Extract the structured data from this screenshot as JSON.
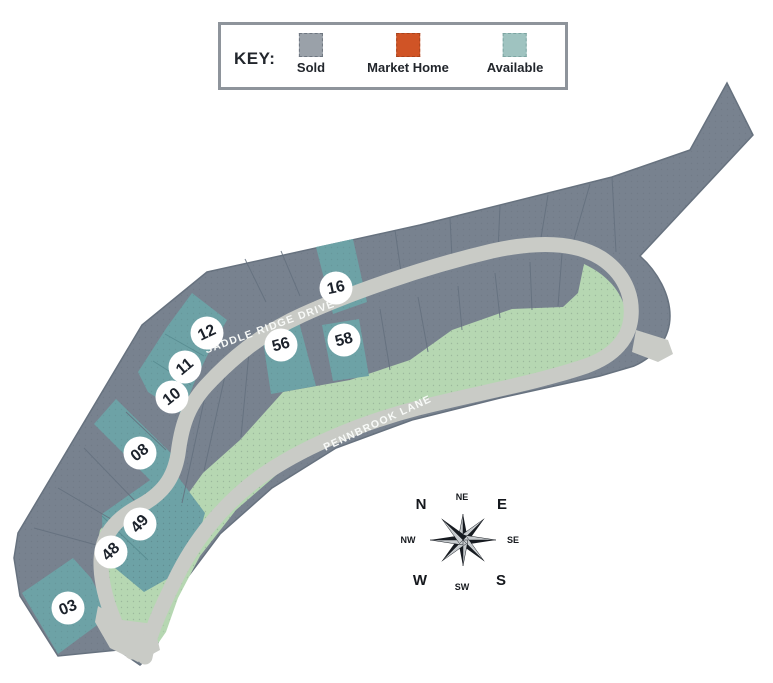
{
  "key": {
    "label": "KEY:",
    "items": [
      {
        "name": "Sold",
        "color": "#9aa1a9",
        "border": "#6e7680"
      },
      {
        "name": "Market Home",
        "color": "#d05426",
        "border": "#a8431d"
      },
      {
        "name": "Available",
        "color": "#9fc3c0",
        "border": "#7da5a2"
      }
    ]
  },
  "map": {
    "colors": {
      "sold_lot": "#78828f",
      "sold_lot_edge": "#67727f",
      "available_lot": "#6da2a6",
      "available_lot_edge": "#55898e",
      "road": "#c9cbc6",
      "open_space": "#b6d7b2",
      "lot_line": "#64707e",
      "badge_bg": "#ffffff",
      "badge_text": "#1c222b",
      "street_text": "#f8faf8"
    },
    "streets": [
      {
        "name": "SADDLE RIDGE DRIVE",
        "x": 271,
        "y": 330,
        "angle": -20
      },
      {
        "name": "PENNBROOK LANE",
        "x": 379,
        "y": 426,
        "angle": -25
      }
    ],
    "lots": [
      {
        "number": "03",
        "status": "Available",
        "x": 68,
        "y": 608,
        "tilt": -22
      },
      {
        "number": "08",
        "status": "Available",
        "x": 140,
        "y": 453,
        "tilt": -38
      },
      {
        "number": "10",
        "status": "Available",
        "x": 172,
        "y": 397,
        "tilt": -38
      },
      {
        "number": "11",
        "status": "Available",
        "x": 185,
        "y": 367,
        "tilt": -40
      },
      {
        "number": "12",
        "status": "Available",
        "x": 207,
        "y": 333,
        "tilt": -25
      },
      {
        "number": "16",
        "status": "Available",
        "x": 336,
        "y": 288,
        "tilt": -12
      },
      {
        "number": "48",
        "status": "Available",
        "x": 111,
        "y": 552,
        "tilt": -45
      },
      {
        "number": "49",
        "status": "Available",
        "x": 140,
        "y": 524,
        "tilt": -48
      },
      {
        "number": "56",
        "status": "Available",
        "x": 281,
        "y": 345,
        "tilt": -15
      },
      {
        "number": "58",
        "status": "Available",
        "x": 344,
        "y": 340,
        "tilt": -15
      }
    ]
  },
  "compass": {
    "points": [
      {
        "text": "N",
        "x": 421,
        "y": 509,
        "size": 15
      },
      {
        "text": "NE",
        "x": 462,
        "y": 500,
        "size": 9
      },
      {
        "text": "E",
        "x": 502,
        "y": 509,
        "size": 15
      },
      {
        "text": "NW",
        "x": 408,
        "y": 543,
        "size": 9
      },
      {
        "text": "SE",
        "x": 513,
        "y": 543,
        "size": 9
      },
      {
        "text": "W",
        "x": 420,
        "y": 585,
        "size": 15
      },
      {
        "text": "SW",
        "x": 462,
        "y": 590,
        "size": 9
      },
      {
        "text": "S",
        "x": 501,
        "y": 585,
        "size": 15
      }
    ]
  }
}
